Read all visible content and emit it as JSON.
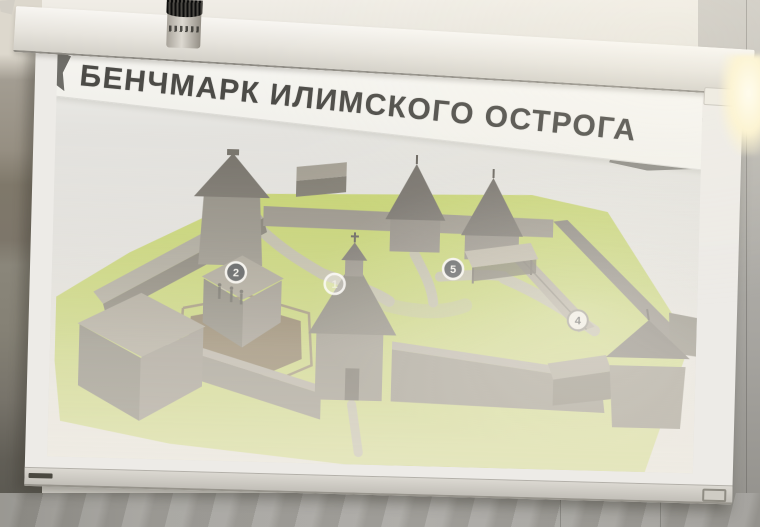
{
  "photo": {
    "setting": "conference-room projector screen photographed at a slight angle",
    "room_objects": [
      "ceiling spotlight cylinder",
      "screen housing bar",
      "left wall",
      "right wall with light reflection",
      "screen bottom bar with pull tab"
    ]
  },
  "slide": {
    "title": "БЕНЧМАРК ИЛИМСКОГО ОСТРОГА",
    "subject": "3D aerial rendering of the wooden Ilimsk ostrog fortress with numbered location markers",
    "markers": [
      {
        "number": "2",
        "style": "dark"
      },
      {
        "number": "1",
        "style": "faded"
      },
      {
        "number": "5",
        "style": "dark"
      },
      {
        "number": "4",
        "style": "light"
      }
    ]
  },
  "colors": {
    "slide_background": "#dddcd8",
    "banner_white": "#f5f4f0",
    "title_text": "#4c4b47",
    "grass_green": "#bccc66",
    "wood_gray": "#908b80",
    "roof_dark": "#6f6b63",
    "pond_brown": "#7b6b4f",
    "marker_dark": "#3f4347",
    "glow_warm": "#fdf4d5"
  }
}
